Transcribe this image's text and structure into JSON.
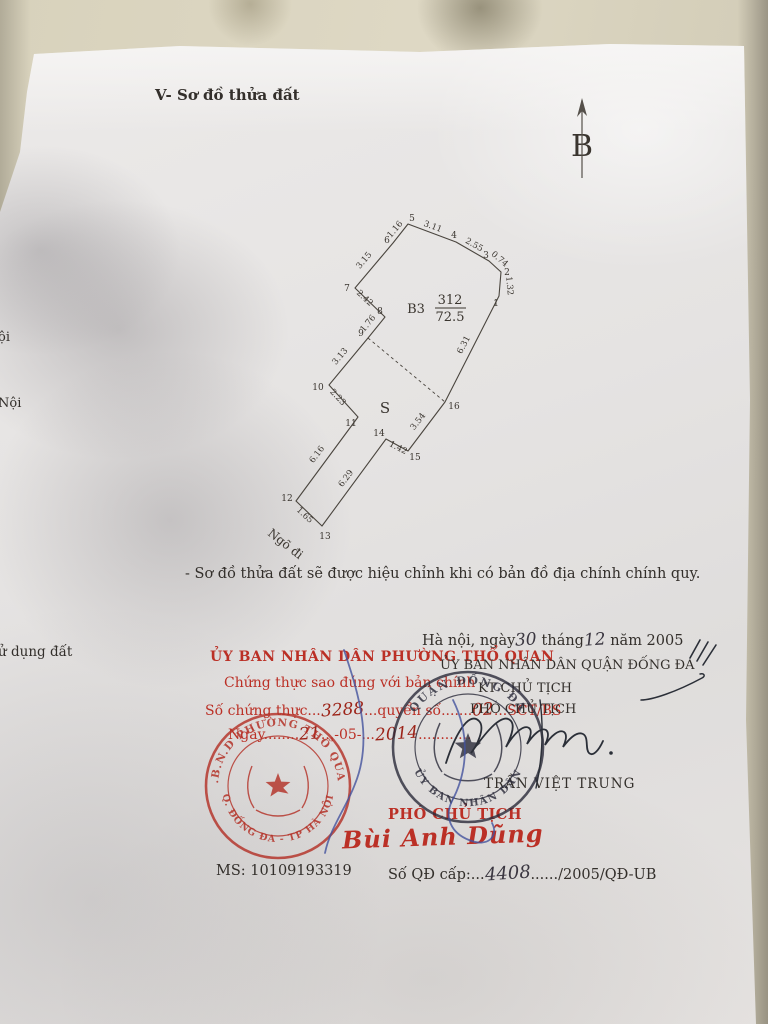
{
  "header": {
    "title": "V- Sơ đồ thửa đất"
  },
  "north": {
    "label": "B"
  },
  "diagram": {
    "plot_code": "B3",
    "plot_number": "312",
    "plot_area": "72.5",
    "section_label": "S",
    "alley_label": "Ngõ đi",
    "vertex_labels": [
      "1",
      "2",
      "3",
      "4",
      "5",
      "6",
      "7",
      "8",
      "9",
      "10",
      "11",
      "12",
      "13",
      "14",
      "15",
      "16"
    ],
    "edges": {
      "e6_5": "1.16",
      "e5_4": "3.11",
      "e4_3": "2.55",
      "e3_2": "0.74",
      "e2_1": "1.32",
      "e1_16": "6.31",
      "e16_15": "3.54",
      "e15_14": "1.42",
      "e14_13": "6.29",
      "e13_12": "1.65",
      "e12_11": "6.16",
      "e11_10": "2.23",
      "e10_9": "3.13",
      "e9_8": "1.76",
      "e8_7": "2.42",
      "e7_6": "3.15"
    }
  },
  "caption": {
    "note": "- Sơ đồ thửa đất sẽ được hiệu chỉnh khi có bản đồ địa chính chính quy."
  },
  "margin": {
    "frag1": "ội",
    "frag2": "Nội",
    "frag3": "ử dụng đất"
  },
  "issuer": {
    "date_prefix": "Hà nội, ngày",
    "date_day": "30",
    "month_label": "tháng",
    "date_month": "12",
    "year_label": "năm 2005",
    "committee": "ỦY BAN NHÂN DÂN QUẬN ĐỐNG ĐA",
    "kt_line": "KT CHỦ TỊCH",
    "deputy_line": "PHÓ CHỦ TỊCH",
    "signer": "TRẦN VIỆT TRUNG"
  },
  "certification": {
    "line1": "ỦY BAN NHÂN DÂN PHƯỜNG THỔ QUAN",
    "line2": "Chứng thực sao đúng với bản chính",
    "line3_prefix": "Số chứng thực...",
    "line3_number": "3288",
    "line3_mid": "...quyển số.......",
    "line3_book": "02",
    "line3_suffix": "...SCT/BS",
    "line4_prefix": "Ngày........",
    "line4_day": "21",
    "line4_mid": "...-05-...",
    "line4_year": "2014",
    "line4_suffix": "............"
  },
  "vice": {
    "title": "PHÓ CHỦ TỊCH",
    "name": "Bùi Anh Dũng"
  },
  "footer": {
    "ms": "MS: 10109193319",
    "qd_prefix": "Số QĐ cấp:...",
    "qd_number": "4408",
    "qd_suffix": "....../2005/QĐ-UB"
  },
  "stamps": {
    "ward_stamp_top": "U.B.N.D PHƯỜNG THỔ QUAN",
    "ward_stamp_bottom": "Q. ĐỐNG ĐA - TP HÀ NỘI",
    "district_stamp_top": "QUẬN ĐỐNG ĐA",
    "district_stamp_bottom": "ỦY BAN NHÂN DÂN",
    "red_color": "#b43228",
    "ink_color": "#2b2b3a"
  }
}
